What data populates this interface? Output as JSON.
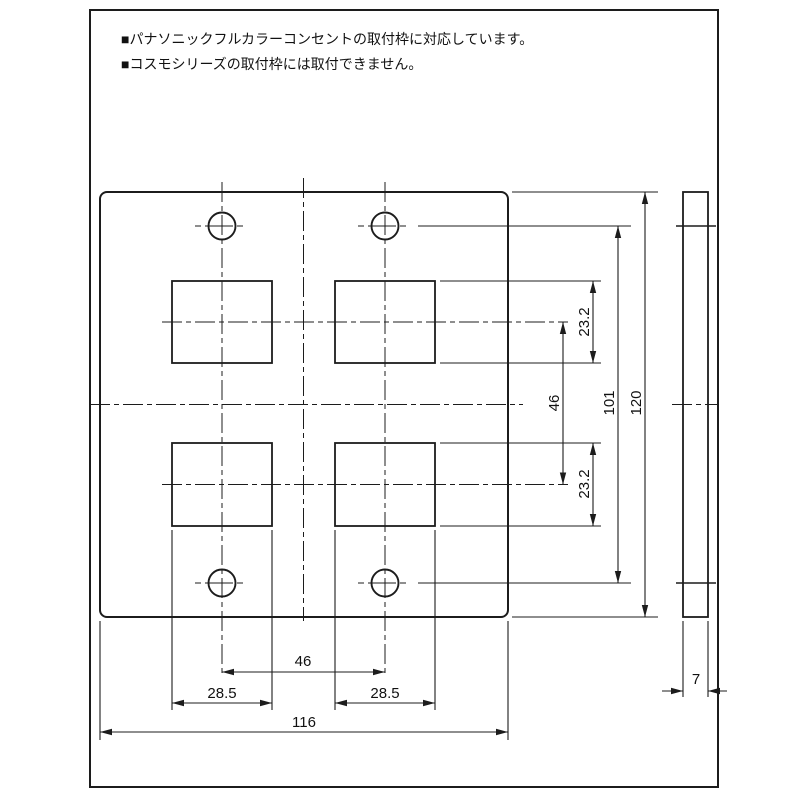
{
  "page": {
    "background": "#ffffff",
    "line_color": "#1c1c1c"
  },
  "notes": {
    "line1": "■パナソニックフルカラーコンセントの取付枠に対応しています。",
    "line2": "■コスモシリーズの取付枠には取付できません。"
  },
  "front_view": {
    "dim_opening_height_top": "23.2",
    "dim_opening_height_bottom": "23.2",
    "dim_row_pitch": "46",
    "dim_screw_pitch_vertical": "101",
    "dim_plate_height": "120",
    "dim_screw_pitch_horizontal": "46",
    "dim_opening_width_left": "28.5",
    "dim_opening_width_right": "28.5",
    "dim_plate_width": "116"
  },
  "side_view": {
    "dim_thickness": "7"
  }
}
